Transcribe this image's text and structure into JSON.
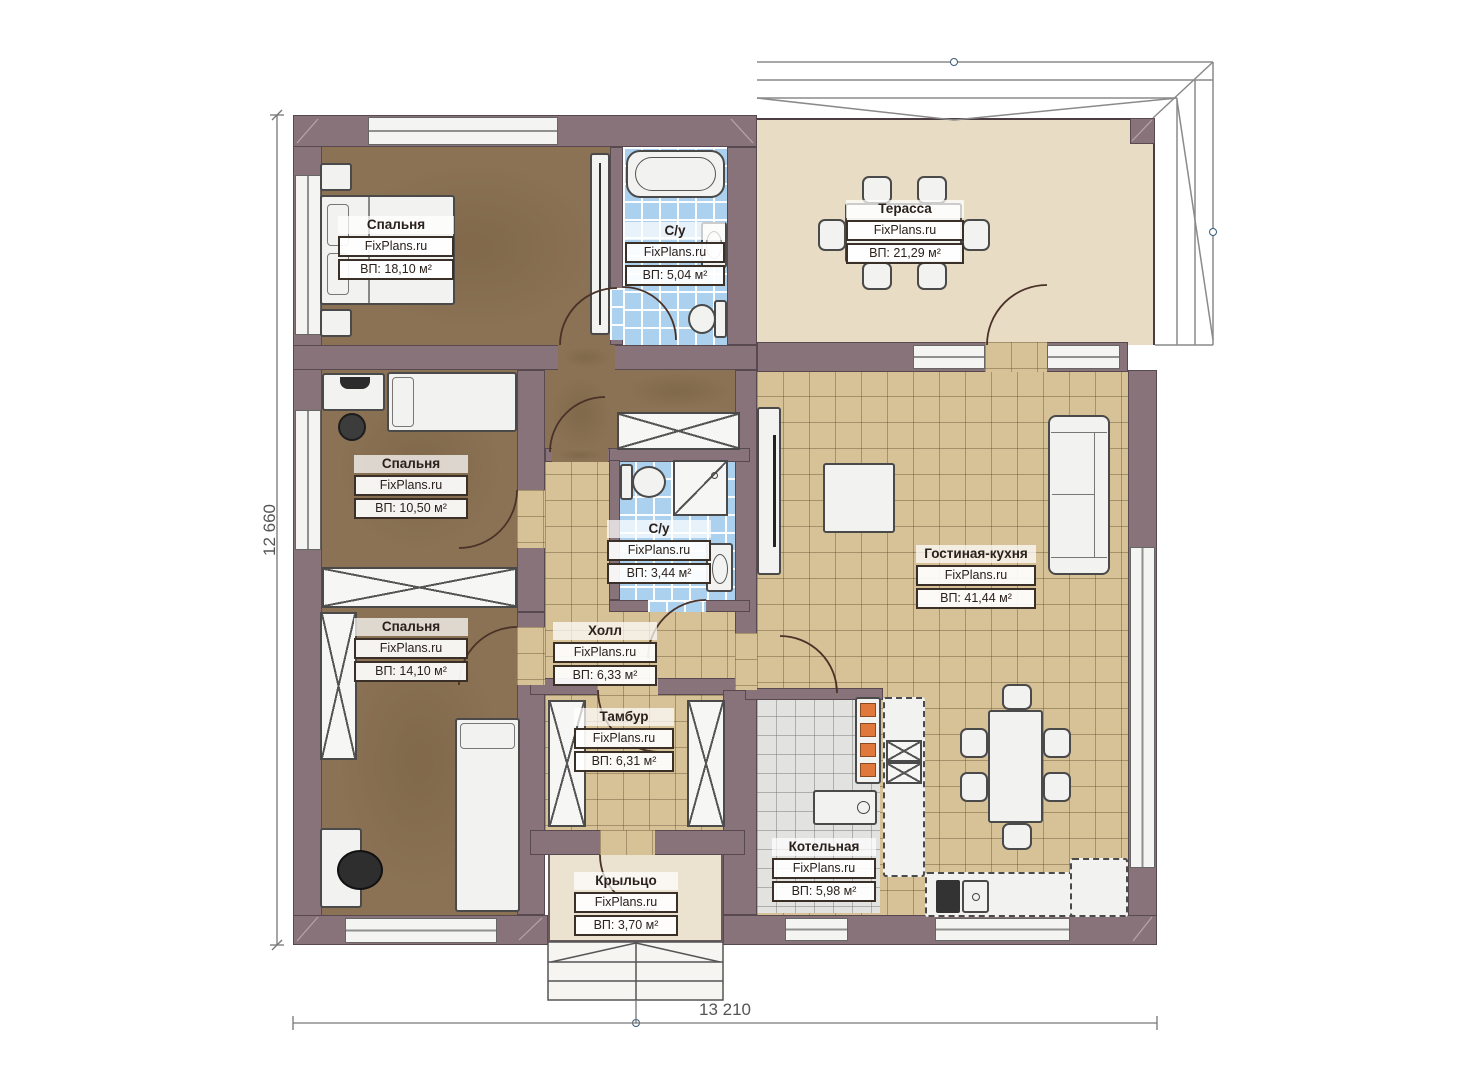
{
  "plan": {
    "watermark": "FixPlans.ru",
    "dim_left": "12 660",
    "dim_bottom": "13 210",
    "rooms": [
      {
        "key": "bedroom-1",
        "name": "Спальня",
        "area": "ВП: 18,10 м²"
      },
      {
        "key": "bathroom-1",
        "name": "С/у",
        "area": "ВП: 5,04 м²"
      },
      {
        "key": "terrace",
        "name": "Терасса",
        "area": "ВП: 21,29 м²"
      },
      {
        "key": "bedroom-2",
        "name": "Спальня",
        "area": "ВП: 10,50 м²"
      },
      {
        "key": "bathroom-2",
        "name": "С/у",
        "area": "ВП: 3,44 м²"
      },
      {
        "key": "living-kitchen",
        "name": "Гостиная-кухня",
        "area": "ВП: 41,44 м²"
      },
      {
        "key": "bedroom-3",
        "name": "Спальня",
        "area": "ВП: 14,10 м²"
      },
      {
        "key": "hall",
        "name": "Холл",
        "area": "ВП: 6,33 м²"
      },
      {
        "key": "vestibule",
        "name": "Тамбур",
        "area": "ВП: 6,31 м²"
      },
      {
        "key": "boiler-room",
        "name": "Котельная",
        "area": "ВП: 5,98 м²"
      },
      {
        "key": "porch",
        "name": "Крыльцо",
        "area": "ВП: 3,70 м²"
      }
    ],
    "colors": {
      "wall": "#89737a",
      "bedroom_floor": "#8b7254",
      "tile_tan": "#d7c298",
      "tile_blue": "#abd1ee",
      "tile_gray": "#e2e2e0",
      "terrace_floor": "#e9dcc5",
      "porch_floor": "#ece2d0",
      "stove_accent": "#e0783c"
    }
  }
}
